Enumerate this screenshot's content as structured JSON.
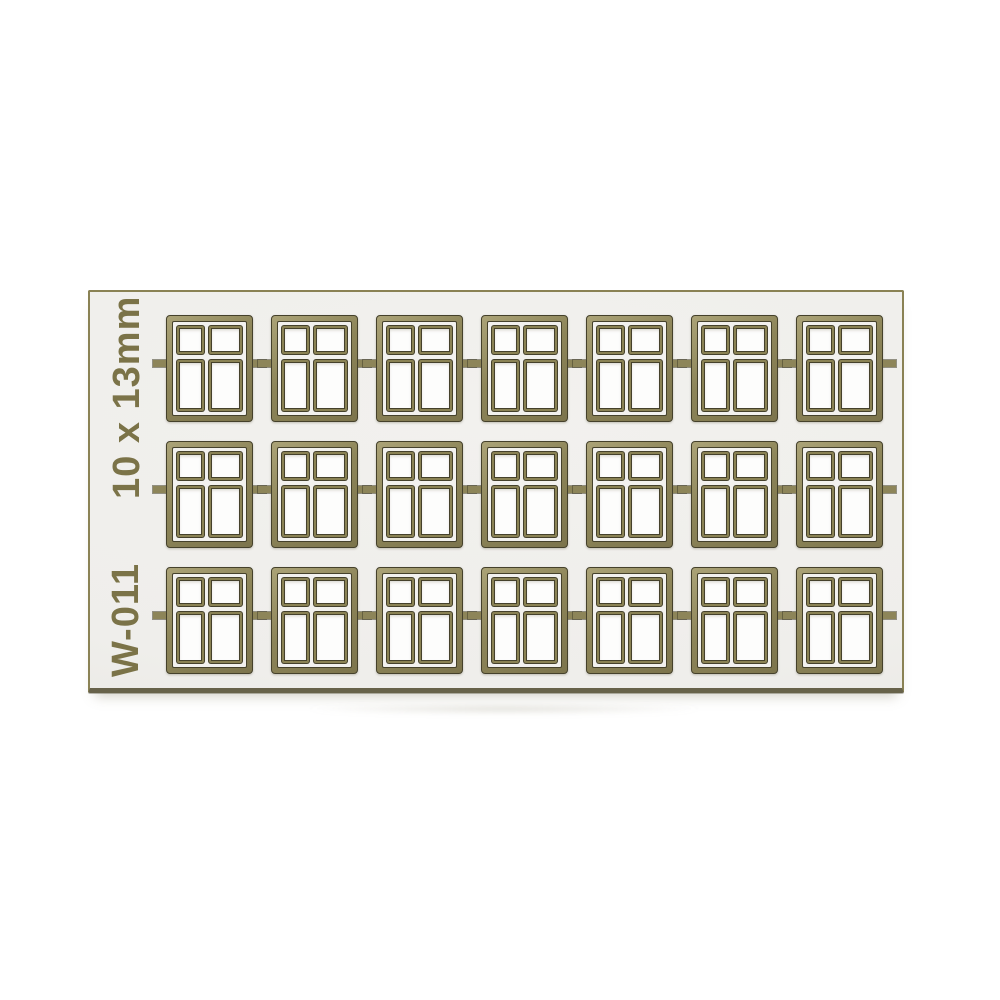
{
  "photo": {
    "description": "Product photo of an etched model-making sheet of miniature four-pane windows",
    "background_color": "#ffffff"
  },
  "sheet": {
    "size_label": "10 x 13mm",
    "product_code": "W-011",
    "grid": {
      "rows": 3,
      "columns": 7,
      "window_count": 21
    },
    "window": {
      "panes_per_window": 4,
      "pane_layout": "2 columns x 2 rows, top panes shorter than bottom panes"
    },
    "colors": {
      "sheet_fill": "#efeeeb",
      "sheet_border": "#8a8254",
      "sheet_bottom_edge": "#67624a",
      "frame_olive": "#8d8559",
      "frame_olive_light": "#aba377",
      "frame_olive_dark": "#7c744c",
      "pane_border_olive": "#8a8254",
      "dark_line": "#45412b",
      "pane_fill": "#fdfdfc",
      "margin_fill": "#f2f1ee",
      "label_text": "#7b7348"
    }
  }
}
